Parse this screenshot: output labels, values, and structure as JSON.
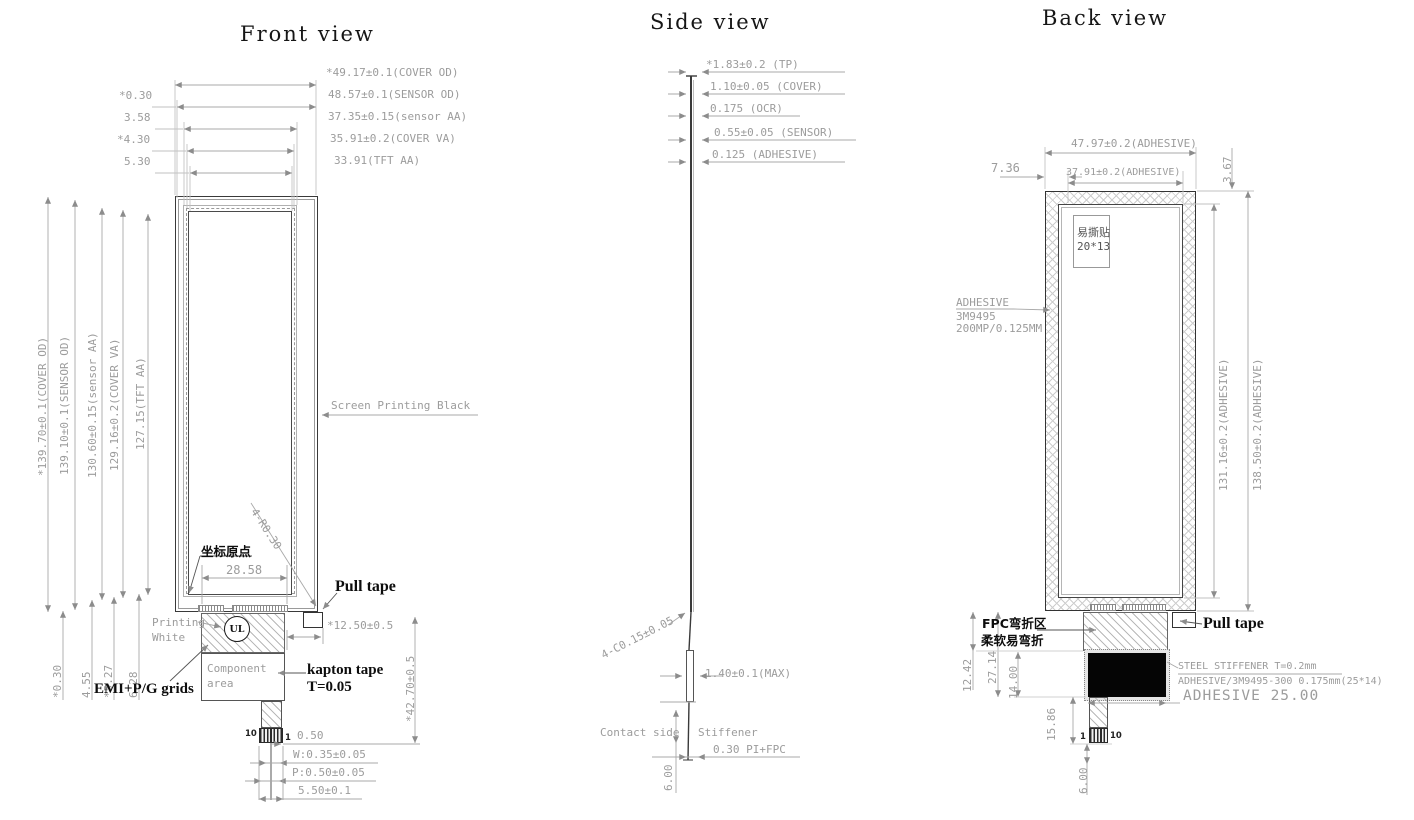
{
  "front": {
    "title": "Front view",
    "top_dims": [
      "*49.17±0.1(COVER OD)",
      "48.57±0.1(SENSOR OD)",
      "37.35±0.15(sensor AA)",
      "35.91±0.2(COVER VA)",
      "33.91(TFT AA)"
    ],
    "top_left_dims": [
      "*0.30",
      "3.58",
      "*4.30",
      "5.30"
    ],
    "left_dims": [
      "*139.70±0.1(COVER OD)",
      "139.10±0.1(SENSOR OD)",
      "130.60±0.15(sensor AA)",
      "129.16±0.2(COVER VA)",
      "127.15(TFT AA)"
    ],
    "bottom_left_dims": [
      "*0.30",
      "4.55",
      "*5.27",
      "6.28"
    ],
    "screen_printing": "Screen Printing Black",
    "corner_radius": "4-R0.30",
    "origin": "坐标原点",
    "bottom_width": "28.58",
    "pull_tape": "Pull tape",
    "pull_tape_offset": "*12.50±0.5",
    "printing1": "Printing",
    "printing2": "White",
    "ul": "UL",
    "component1": "Component",
    "component2": "area",
    "kapton1": "kapton tape",
    "kapton2": "T=0.05",
    "emi": "EMI+P/G grids",
    "fpc_length": "*42.70±0.5",
    "pin_left": "10",
    "pin_right": "1",
    "pin_dims": [
      "0.50",
      "W:0.35±0.05",
      "P:0.50±0.05",
      "5.50±0.1"
    ]
  },
  "side": {
    "title": "Side view",
    "top_dims": [
      "*1.83±0.2 (TP)",
      "1.10±0.05 (COVER)",
      "0.175 (OCR)",
      "0.55±0.05 (SENSOR)",
      "0.125 (ADHESIVE)"
    ],
    "chamfer": "4-C0.15±0.05",
    "max_thickness": "1.40±0.1(MAX)",
    "contact_side": "Contact side",
    "stiffener": "Stiffener",
    "fpc_stack": "0.30 PI+FPC",
    "bottom_length": "6.00"
  },
  "back": {
    "title": "Back view",
    "adhesive_od": "47.97±0.2(ADHESIVE)",
    "left_offset": "7.36",
    "adhesive_inner": "37.91±0.2(ADHESIVE)",
    "top_offset": "3.67",
    "sticker1": "易撕贴",
    "sticker2": "20*13",
    "adhesive1": "ADHESIVE",
    "adhesive2": "3M9495",
    "adhesive3": "200MP/0.125MM",
    "right_dims": [
      "131.16±0.2(ADHESIVE)",
      "138.50±0.2(ADHESIVE)"
    ],
    "fpc1": "FPC弯折区",
    "fpc2": "柔软易弯折",
    "pull_tape": "Pull tape",
    "d_12_42": "12.42",
    "d_27_14": "27.14",
    "d_14_00": "14.00",
    "d_15_86": "15.86",
    "d_6_00": "6.00",
    "steel1": "STEEL STIFFENER  T=0.2mm",
    "steel2": "ADHESIVE/3M9495-300 0.175mm(25*14)",
    "adhesive_width": "ADHESIVE 25.00",
    "pin_left": "1",
    "pin_right": "10"
  },
  "colors": {
    "outline": "#3a3a3a",
    "dim": "#9c9c9c",
    "text": "#111111"
  }
}
